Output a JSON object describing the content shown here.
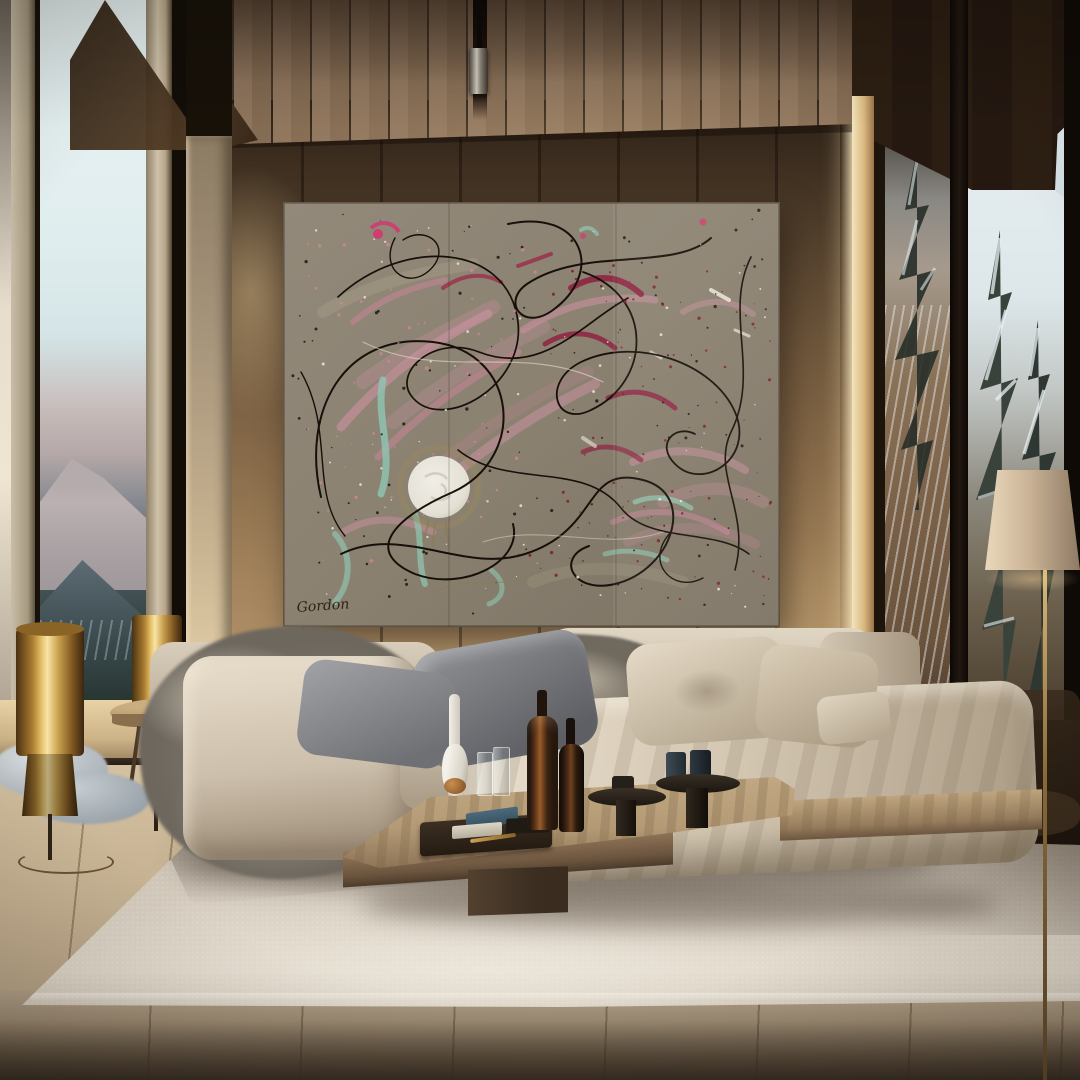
{
  "scene": {
    "setting": "modern chalet living room with floor-to-ceiling windows and mountain forest views",
    "lighting": "low warm sunlight from the right"
  },
  "painting": {
    "signature": "Gordon",
    "style": "abstract drip painting with textured moon motif",
    "palette": {
      "canvas": "#8d8373",
      "pink": "#c9909f",
      "crimson": "#8f2342",
      "magenta": "#d6336c",
      "teal": "#8fc7b4",
      "line_black": "#17100a",
      "white": "#ece7da",
      "moon": "#e9e5da",
      "halo_gold": "#9a8a5a"
    },
    "speckles": {
      "seed": 7,
      "groups": [
        {
          "color": "#17100a",
          "count": 120,
          "x": 8,
          "y": 8,
          "w": 480,
          "h": 405,
          "rmin": 0.5,
          "rmax": 1.7,
          "opacity": 0.8
        },
        {
          "color": "#7e1d2c",
          "count": 80,
          "x": 240,
          "y": 60,
          "w": 248,
          "h": 340,
          "rmin": 0.5,
          "rmax": 1.7,
          "opacity": 0.85
        },
        {
          "color": "#f1ede2",
          "count": 65,
          "x": 30,
          "y": 15,
          "w": 455,
          "h": 390,
          "rmin": 0.5,
          "rmax": 1.5,
          "opacity": 0.8
        },
        {
          "color": "#d988a0",
          "count": 50,
          "x": 25,
          "y": 40,
          "w": 235,
          "h": 320,
          "rmin": 0.6,
          "rmax": 1.8,
          "opacity": 0.7
        }
      ]
    }
  },
  "materials": {
    "ceiling_wood": "#8a715a",
    "wall_wood": "#a3845c",
    "brass_lamps": "#e8c36a",
    "sofa_fabric": "#d2c6b3",
    "grey_pillow": "#77777c",
    "rug": "#d7cec0",
    "floor_wood": "#c9b697",
    "lamp_shade": "#cdb99d",
    "window_sky": "#e8f2f2",
    "snow_forest": "#e7eef1"
  }
}
